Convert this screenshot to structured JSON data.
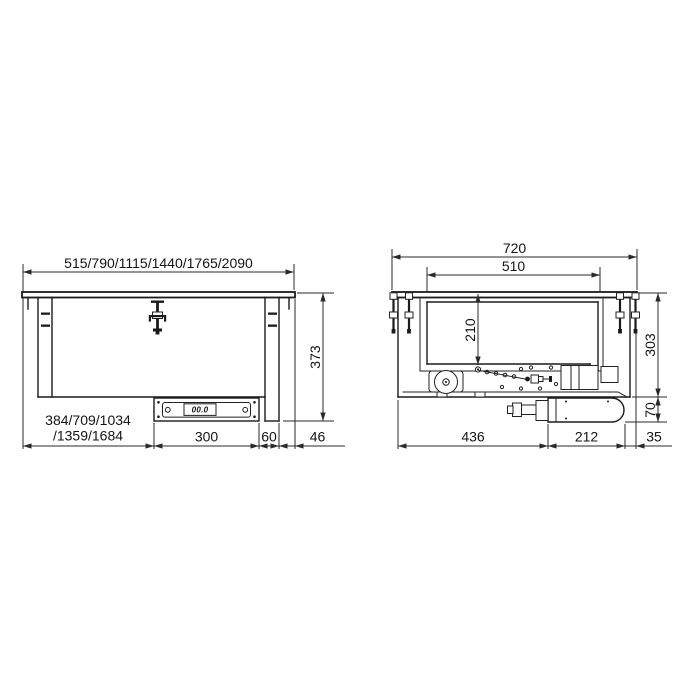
{
  "front_view": {
    "overall_widths": "515/790/1115/1440/1765/2090",
    "cutout_widths_line1": "384/709/1034",
    "cutout_widths_line2": "/1359/1684",
    "control_panel_width": "300",
    "panel_to_body_edge": "60",
    "flange_overhang": "46",
    "overall_depth": "373",
    "display_value": "00.0"
  },
  "side_view": {
    "overall_depth": "720",
    "well_opening_depth": "510",
    "well_depth": "210",
    "body_height": "303",
    "motor_unit_height": "70",
    "front_section_depth": "436",
    "motor_section_depth": "212",
    "rear_overhang": "35"
  }
}
